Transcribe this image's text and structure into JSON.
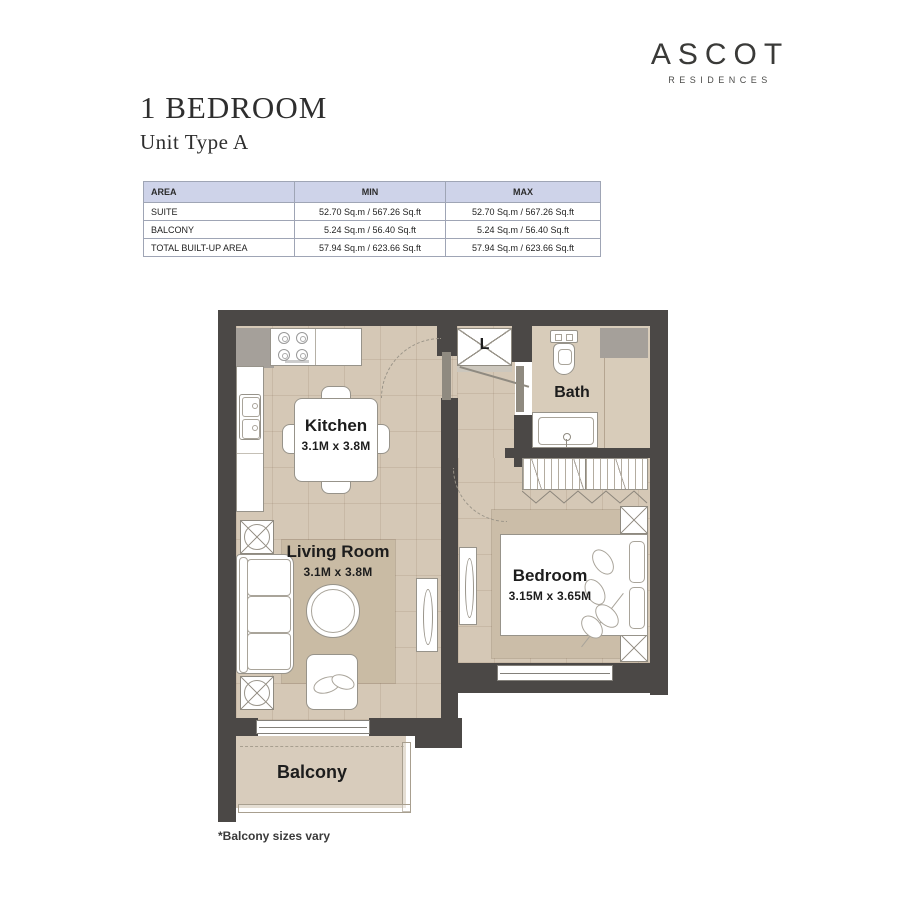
{
  "brand": {
    "name": "ASCOT",
    "tagline": "RESIDENCES"
  },
  "header": {
    "title": "1 BEDROOM",
    "subtitle": "Unit Type A"
  },
  "area_table": {
    "columns": [
      "AREA",
      "MIN",
      "MAX"
    ],
    "rows": [
      {
        "area": "SUITE",
        "min": "52.70 Sq.m / 567.26 Sq.ft",
        "max": "52.70 Sq.m / 567.26 Sq.ft"
      },
      {
        "area": "BALCONY",
        "min": "5.24 Sq.m / 56.40 Sq.ft",
        "max": "5.24 Sq.m / 56.40 Sq.ft"
      },
      {
        "area": "TOTAL BUILT-UP AREA",
        "min": "57.94 Sq.m / 623.66 Sq.ft",
        "max": "57.94 Sq.m / 623.66 Sq.ft"
      }
    ]
  },
  "floorplan": {
    "kitchen_label": "Kitchen",
    "kitchen_dims": "3.1M x 3.8M",
    "living_label": "Living Room",
    "living_dims": "3.1M x 3.8M",
    "bedroom_label": "Bedroom",
    "bedroom_dims": "3.15M x 3.65M",
    "bath_label": "Bath",
    "balcony_label": "Balcony",
    "laundry_label": "L"
  },
  "footnote": "*Balcony sizes vary",
  "colors": {
    "wall": "#4b4846",
    "floor": "#d5c8b6",
    "rug": "#c9bba4",
    "table_header": "#ced3e9"
  }
}
